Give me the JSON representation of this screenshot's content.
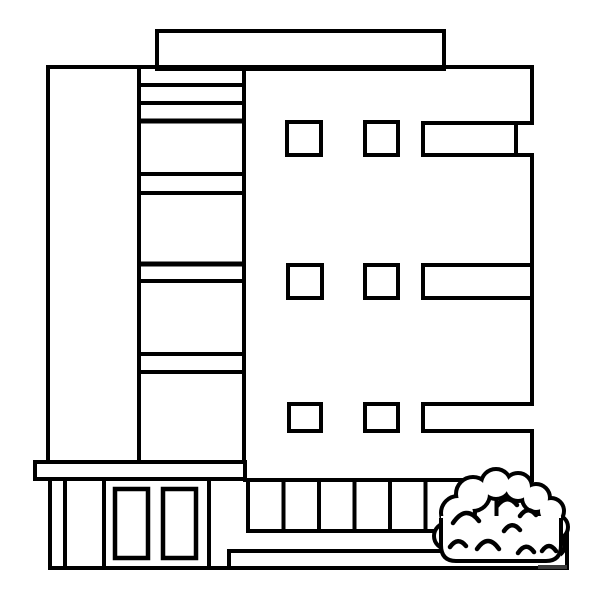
{
  "meta": {
    "description": "Black-and-white coloring-page line illustration of a modern multi-storey building with rooftop structure, striped stairwell column, window grid, entrance with double doors, colonnade, steps and a scalloped bush at the lower right",
    "background_color": "#ffffff",
    "line_color": "#000000",
    "canvas": {
      "width": 600,
      "height": 600
    }
  },
  "watermark": {
    "text": ""
  },
  "scene": {
    "width": 600,
    "height": 600,
    "shapes": [
      {
        "n": "rooftop-structure",
        "t": "rect",
        "x": 157,
        "y": 31,
        "w": 287,
        "h": 38,
        "sw": 4
      },
      {
        "n": "building-top-edge",
        "t": "line",
        "x1": 46,
        "y1": 67,
        "x2": 534,
        "y2": 67,
        "sw": 4
      },
      {
        "n": "building-left-edge",
        "t": "line",
        "x1": 48,
        "y1": 65,
        "x2": 48,
        "y2": 462,
        "sw": 4
      },
      {
        "n": "building-right-edge-upper",
        "t": "line",
        "x1": 532,
        "y1": 65,
        "x2": 532,
        "y2": 123,
        "sw": 4
      },
      {
        "n": "building-right-edge-middle",
        "t": "line",
        "x1": 532,
        "y1": 153,
        "x2": 532,
        "y2": 406,
        "sw": 4
      },
      {
        "n": "building-right-edge-lower",
        "t": "line",
        "x1": 532,
        "y1": 429,
        "x2": 532,
        "y2": 482,
        "sw": 4
      },
      {
        "n": "stairwell-column-left-edge",
        "t": "line",
        "x1": 139,
        "y1": 65,
        "x2": 139,
        "y2": 462,
        "sw": 4
      },
      {
        "n": "stairwell-column-right-edge",
        "t": "line",
        "x1": 244,
        "y1": 65,
        "x2": 244,
        "y2": 462,
        "sw": 4
      },
      {
        "n": "stairwell-stripe-1",
        "t": "line",
        "x1": 137,
        "y1": 85,
        "x2": 246,
        "y2": 85,
        "sw": 4
      },
      {
        "n": "stairwell-stripe-2",
        "t": "line",
        "x1": 137,
        "y1": 103,
        "x2": 246,
        "y2": 103,
        "sw": 4
      },
      {
        "n": "stairwell-stripe-3",
        "t": "line",
        "x1": 137,
        "y1": 121,
        "x2": 246,
        "y2": 121,
        "sw": 5
      },
      {
        "n": "stairwell-stripe-4",
        "t": "line",
        "x1": 137,
        "y1": 174,
        "x2": 246,
        "y2": 174,
        "sw": 4
      },
      {
        "n": "stairwell-stripe-5",
        "t": "line",
        "x1": 137,
        "y1": 193,
        "x2": 246,
        "y2": 193,
        "sw": 4
      },
      {
        "n": "stairwell-stripe-6",
        "t": "line",
        "x1": 137,
        "y1": 264,
        "x2": 246,
        "y2": 264,
        "sw": 5
      },
      {
        "n": "stairwell-stripe-7",
        "t": "line",
        "x1": 137,
        "y1": 281,
        "x2": 246,
        "y2": 281,
        "sw": 4
      },
      {
        "n": "stairwell-stripe-8",
        "t": "line",
        "x1": 137,
        "y1": 354,
        "x2": 246,
        "y2": 354,
        "sw": 4
      },
      {
        "n": "stairwell-stripe-9",
        "t": "line",
        "x1": 137,
        "y1": 372,
        "x2": 246,
        "y2": 372,
        "sw": 4
      },
      {
        "n": "window-floor1-square1",
        "t": "rect",
        "x": 287,
        "y": 122,
        "w": 34,
        "h": 33,
        "sw": 4
      },
      {
        "n": "window-floor1-square2",
        "t": "rect",
        "x": 365,
        "y": 122,
        "w": 33,
        "h": 33,
        "sw": 4
      },
      {
        "n": "window-floor1-wide-top",
        "t": "line",
        "x1": 421,
        "y1": 123,
        "x2": 534,
        "y2": 123,
        "sw": 4
      },
      {
        "n": "window-floor1-wide-bottom",
        "t": "line",
        "x1": 421,
        "y1": 155,
        "x2": 534,
        "y2": 155,
        "sw": 4
      },
      {
        "n": "window-floor1-wide-left",
        "t": "line",
        "x1": 423,
        "y1": 121,
        "x2": 423,
        "y2": 157,
        "sw": 4
      },
      {
        "n": "window-floor1-wide-inner-right",
        "t": "line",
        "x1": 516,
        "y1": 121,
        "x2": 516,
        "y2": 157,
        "sw": 4
      },
      {
        "n": "window-floor2-square1",
        "t": "rect",
        "x": 288,
        "y": 265,
        "w": 34,
        "h": 33,
        "sw": 4
      },
      {
        "n": "window-floor2-square2",
        "t": "rect",
        "x": 365,
        "y": 265,
        "w": 33,
        "h": 33,
        "sw": 4
      },
      {
        "n": "window-floor2-wide-top",
        "t": "line",
        "x1": 421,
        "y1": 265,
        "x2": 532,
        "y2": 265,
        "sw": 4
      },
      {
        "n": "window-floor2-wide-bottom",
        "t": "line",
        "x1": 421,
        "y1": 298,
        "x2": 532,
        "y2": 298,
        "sw": 4
      },
      {
        "n": "window-floor2-wide-left",
        "t": "line",
        "x1": 423,
        "y1": 263,
        "x2": 423,
        "y2": 300,
        "sw": 4
      },
      {
        "n": "window-floor3-square1",
        "t": "rect",
        "x": 289,
        "y": 404,
        "w": 32,
        "h": 27,
        "sw": 4
      },
      {
        "n": "window-floor3-square2",
        "t": "rect",
        "x": 365,
        "y": 404,
        "w": 33,
        "h": 27,
        "sw": 4
      },
      {
        "n": "window-floor3-wide-top",
        "t": "line",
        "x1": 421,
        "y1": 404,
        "x2": 534,
        "y2": 404,
        "sw": 4
      },
      {
        "n": "window-floor3-wide-bottom",
        "t": "line",
        "x1": 421,
        "y1": 431,
        "x2": 534,
        "y2": 431,
        "sw": 4
      },
      {
        "n": "window-floor3-wide-left",
        "t": "line",
        "x1": 423,
        "y1": 402,
        "x2": 423,
        "y2": 433,
        "sw": 4
      },
      {
        "n": "entrance-ledge",
        "t": "rect",
        "x": 35,
        "y": 462,
        "w": 210,
        "h": 17,
        "sw": 4
      },
      {
        "n": "colonnade-top-edge",
        "t": "line",
        "x1": 243,
        "y1": 480,
        "x2": 534,
        "y2": 480,
        "sw": 4
      },
      {
        "n": "colonnade-pillar-1",
        "t": "line",
        "x1": 248,
        "y1": 480,
        "x2": 248,
        "y2": 533,
        "sw": 4
      },
      {
        "n": "colonnade-pillar-2",
        "t": "line",
        "x1": 283.5,
        "y1": 480,
        "x2": 283.5,
        "y2": 533,
        "sw": 4
      },
      {
        "n": "colonnade-pillar-3",
        "t": "line",
        "x1": 319,
        "y1": 480,
        "x2": 319,
        "y2": 533,
        "sw": 4
      },
      {
        "n": "colonnade-pillar-4",
        "t": "line",
        "x1": 354.5,
        "y1": 480,
        "x2": 354.5,
        "y2": 533,
        "sw": 4
      },
      {
        "n": "colonnade-pillar-5",
        "t": "line",
        "x1": 390,
        "y1": 480,
        "x2": 390,
        "y2": 533,
        "sw": 4
      },
      {
        "n": "colonnade-pillar-6",
        "t": "line",
        "x1": 425.5,
        "y1": 480,
        "x2": 425.5,
        "y2": 533,
        "sw": 4
      },
      {
        "n": "colonnade-pillar-7",
        "t": "line",
        "x1": 461,
        "y1": 480,
        "x2": 461,
        "y2": 533,
        "sw": 4
      },
      {
        "n": "colonnade-pillar-8",
        "t": "line",
        "x1": 496.5,
        "y1": 480,
        "x2": 496.5,
        "y2": 533,
        "sw": 4
      },
      {
        "n": "colonnade-rail",
        "t": "line",
        "x1": 246,
        "y1": 531,
        "x2": 569,
        "y2": 531,
        "sw": 4
      },
      {
        "n": "platform-right-edge",
        "t": "line",
        "x1": 567,
        "y1": 529,
        "x2": 567,
        "y2": 570,
        "sw": 4
      },
      {
        "n": "step-top-edge",
        "t": "line",
        "x1": 229,
        "y1": 551,
        "x2": 550,
        "y2": 551,
        "sw": 4
      },
      {
        "n": "step-left-edge",
        "t": "line",
        "x1": 229,
        "y1": 549,
        "x2": 229,
        "y2": 570,
        "sw": 4
      },
      {
        "n": "ground-line",
        "t": "line",
        "x1": 48,
        "y1": 568,
        "x2": 569,
        "y2": 568,
        "sw": 4
      },
      {
        "n": "entrance-wall-outer",
        "t": "line",
        "x1": 50,
        "y1": 479,
        "x2": 50,
        "y2": 570,
        "sw": 4
      },
      {
        "n": "entrance-wall-inner",
        "t": "line",
        "x1": 65,
        "y1": 479,
        "x2": 65,
        "y2": 568,
        "sw": 4
      },
      {
        "n": "door-frame-left",
        "t": "line",
        "x1": 104,
        "y1": 479,
        "x2": 104,
        "y2": 568,
        "sw": 4
      },
      {
        "n": "door-frame-right",
        "t": "line",
        "x1": 209,
        "y1": 479,
        "x2": 209,
        "y2": 568,
        "sw": 4
      },
      {
        "n": "door-panel-left",
        "t": "rect",
        "x": 115,
        "y": 489,
        "w": 33,
        "h": 69,
        "sw": 4.5
      },
      {
        "n": "door-panel-right",
        "t": "rect",
        "x": 163,
        "y": 489,
        "w": 33,
        "h": 69,
        "sw": 4.5
      },
      {
        "n": "bush-bump-outline-1",
        "t": "circle",
        "cx": 458,
        "cy": 513,
        "r": 15,
        "f": "#ffffff",
        "sw": 8
      },
      {
        "n": "bush-bump-outline-2",
        "t": "circle",
        "cx": 473,
        "cy": 494,
        "r": 15,
        "f": "#ffffff",
        "sw": 8
      },
      {
        "n": "bush-bump-outline-3",
        "t": "circle",
        "cx": 496,
        "cy": 484,
        "r": 13,
        "f": "#ffffff",
        "sw": 8
      },
      {
        "n": "bush-bump-outline-4",
        "t": "circle",
        "cx": 518,
        "cy": 487,
        "r": 12,
        "f": "#ffffff",
        "sw": 8
      },
      {
        "n": "bush-bump-outline-5",
        "t": "circle",
        "cx": 536,
        "cy": 498,
        "r": 12,
        "f": "#ffffff",
        "sw": 8
      },
      {
        "n": "bush-bump-outline-6",
        "t": "circle",
        "cx": 551,
        "cy": 511,
        "r": 11,
        "f": "#ffffff",
        "sw": 8
      },
      {
        "n": "bush-bump-outline-7",
        "t": "circle",
        "cx": 556,
        "cy": 527,
        "r": 10,
        "f": "#ffffff",
        "sw": 8
      },
      {
        "n": "bush-bump-outline-8",
        "t": "circle",
        "cx": 553,
        "cy": 545,
        "r": 10,
        "f": "#ffffff",
        "sw": 8
      },
      {
        "n": "bush-bump-outline-9",
        "t": "circle",
        "cx": 447,
        "cy": 536,
        "r": 11,
        "f": "#ffffff",
        "sw": 8
      },
      {
        "n": "bush-bump-fill-1",
        "t": "circle",
        "cx": 458,
        "cy": 513,
        "r": 15,
        "f": "#ffffff",
        "s": "none"
      },
      {
        "n": "bush-bump-fill-2",
        "t": "circle",
        "cx": 473,
        "cy": 494,
        "r": 15,
        "f": "#ffffff",
        "s": "none"
      },
      {
        "n": "bush-bump-fill-3",
        "t": "circle",
        "cx": 496,
        "cy": 484,
        "r": 13,
        "f": "#ffffff",
        "s": "none"
      },
      {
        "n": "bush-bump-fill-4",
        "t": "circle",
        "cx": 518,
        "cy": 487,
        "r": 12,
        "f": "#ffffff",
        "s": "none"
      },
      {
        "n": "bush-bump-fill-5",
        "t": "circle",
        "cx": 536,
        "cy": 498,
        "r": 12,
        "f": "#ffffff",
        "s": "none"
      },
      {
        "n": "bush-bump-fill-6",
        "t": "circle",
        "cx": 551,
        "cy": 511,
        "r": 11,
        "f": "#ffffff",
        "s": "none"
      },
      {
        "n": "bush-bump-fill-7",
        "t": "circle",
        "cx": 556,
        "cy": 527,
        "r": 10,
        "f": "#ffffff",
        "s": "none"
      },
      {
        "n": "bush-bump-fill-8",
        "t": "circle",
        "cx": 553,
        "cy": 545,
        "r": 10,
        "f": "#ffffff",
        "s": "none"
      },
      {
        "n": "bush-bump-fill-9",
        "t": "circle",
        "cx": 447,
        "cy": 536,
        "r": 11,
        "f": "#ffffff",
        "s": "none"
      },
      {
        "n": "bush-base-fill",
        "t": "path",
        "d": "M441 516 H561 V560 H441 Z",
        "f": "#ffffff",
        "s": "none"
      },
      {
        "n": "bush-base-outline",
        "t": "path",
        "d": "M441 518 L441 545 Q441 561 456 561 L546 561 Q561 561 561 545 L561 518",
        "sw": 4
      },
      {
        "n": "bush-leaf-arc-1",
        "t": "path",
        "d": "M453 523 Q466 504 479 521",
        "sw": 4.5,
        "lc": "round"
      },
      {
        "n": "bush-leaf-arc-2",
        "t": "path",
        "d": "M497 506 Q507 493 517 505",
        "sw": 4.5,
        "lc": "round"
      },
      {
        "n": "bush-leaf-arc-3",
        "t": "path",
        "d": "M520 516 Q528 505 536 515",
        "sw": 4.5,
        "lc": "round"
      },
      {
        "n": "bush-leaf-arc-4",
        "t": "path",
        "d": "M504 531 Q512 520 520 530",
        "sw": 4.5,
        "lc": "round"
      },
      {
        "n": "bush-leaf-arc-5",
        "t": "path",
        "d": "M450 547 Q458 536 466 546",
        "sw": 4.5,
        "lc": "round"
      },
      {
        "n": "bush-leaf-arc-6",
        "t": "path",
        "d": "M477 549 Q488 533 499 549",
        "sw": 4.5,
        "lc": "round"
      },
      {
        "n": "bush-leaf-arc-7",
        "t": "path",
        "d": "M518 553 Q526 541 534 552",
        "sw": 4.5,
        "lc": "round"
      },
      {
        "n": "bush-leaf-arc-8",
        "t": "path",
        "d": "M542 551 Q549 541 556 551",
        "sw": 4.5,
        "lc": "round"
      },
      {
        "n": "watermark",
        "t": "rect",
        "x": 538,
        "y": 565,
        "w": 29,
        "h": 4,
        "f": "#3a3a3a",
        "s": "none"
      }
    ]
  }
}
